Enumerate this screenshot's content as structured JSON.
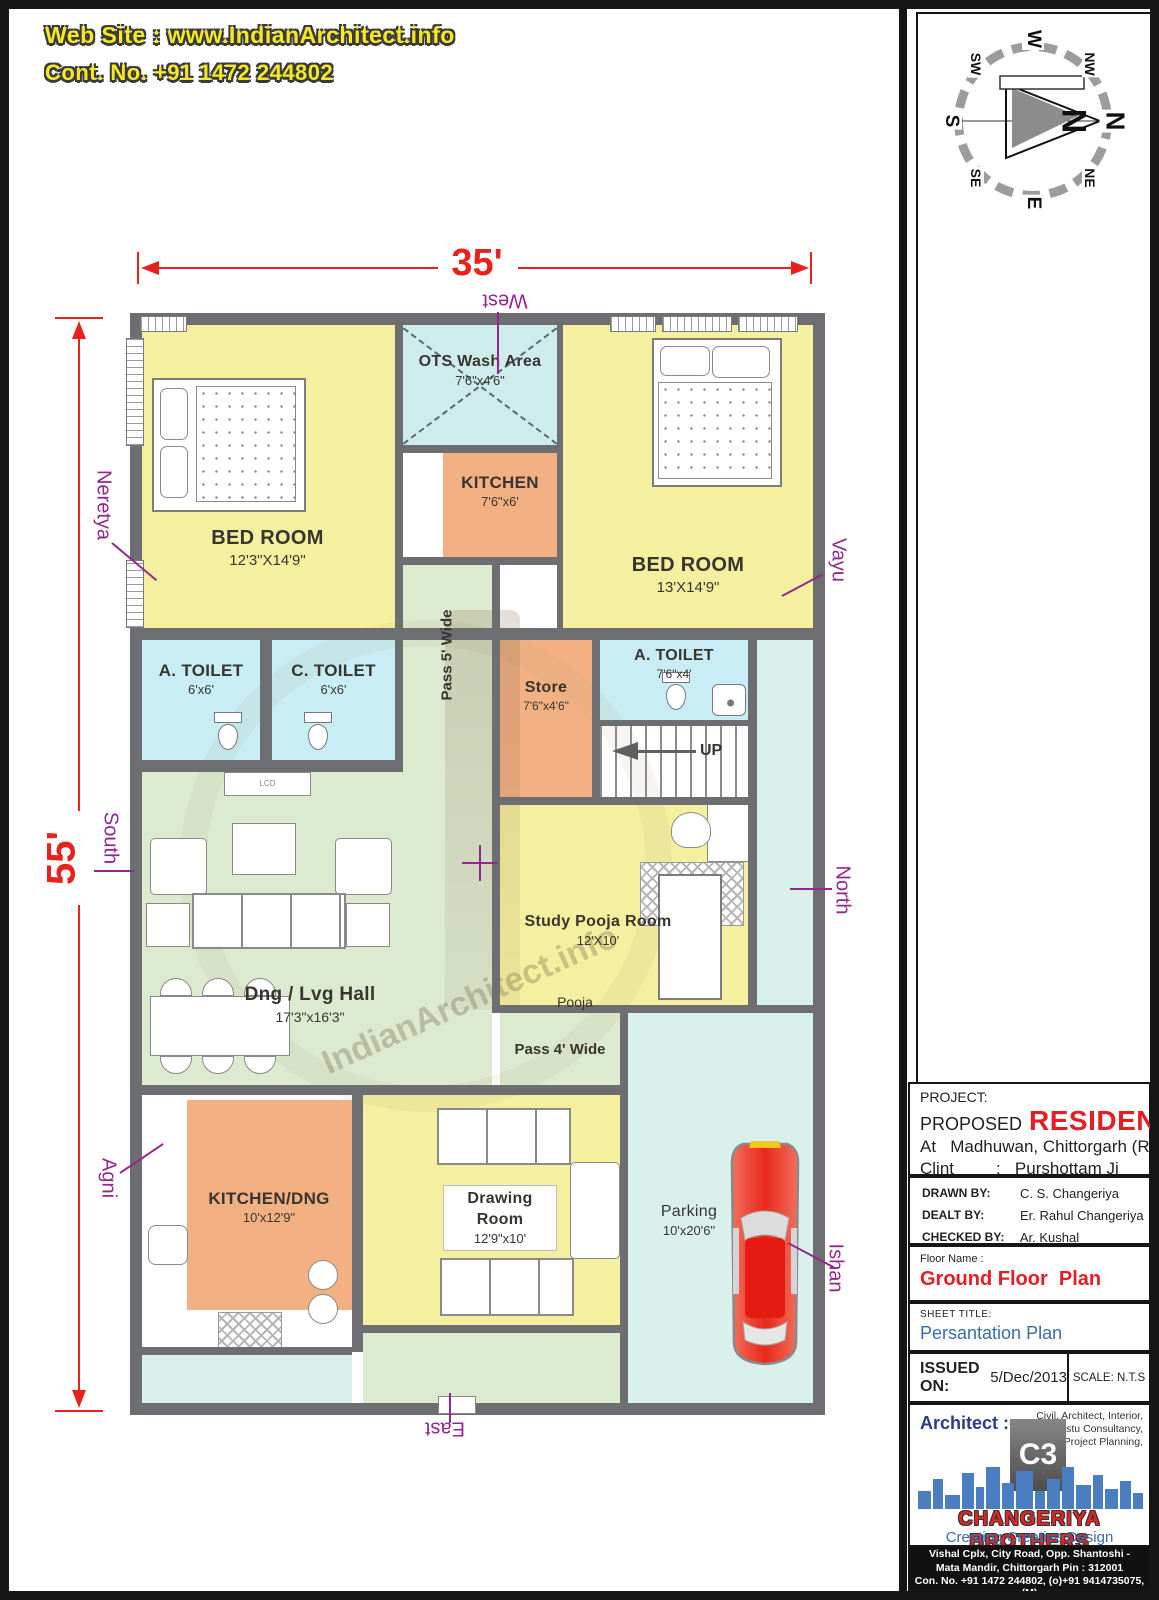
{
  "header": {
    "website": "Web Site : www.IndianArchitect.info",
    "contact": "Cont. No. +91 1472 244802"
  },
  "compass": {
    "n": "N",
    "ne": "NE",
    "e": "E",
    "se": "SE",
    "s": "S",
    "sw": "SW",
    "w": "W",
    "nw": "NW",
    "needle_n": "N"
  },
  "dimensions": {
    "width": "35'",
    "height": "55'"
  },
  "vastu": {
    "west": "West",
    "east": "East",
    "north": "North",
    "south": "South",
    "neretya": "Neretya",
    "vayu": "Vayu",
    "agni": "Agni",
    "ishan": "Ishan"
  },
  "rooms": {
    "bedroom1": {
      "name": "BED ROOM",
      "size": "12'3\"X14'9\""
    },
    "ots": {
      "name": "OTS Wash Area",
      "size": "7'6\"x4'6\""
    },
    "kitchen": {
      "name": "KITCHEN",
      "size": "7'6\"x6'"
    },
    "bedroom2": {
      "name": "BED ROOM",
      "size": "13'X14'9\""
    },
    "atoilet1": {
      "name": "A. TOILET",
      "size": "6'x6'"
    },
    "ctoilet": {
      "name": "C. TOILET",
      "size": "6'x6'"
    },
    "pass5": {
      "name": "Pass 5' Wide"
    },
    "store": {
      "name": "Store",
      "size": "7'6\"x4'6\""
    },
    "atoilet2": {
      "name": "A. TOILET",
      "size": "7'6\"x4'"
    },
    "stairs": {
      "name": "UP"
    },
    "hall": {
      "name": "Dng / Lvg Hall",
      "size": "17'3\"x16'3\""
    },
    "study": {
      "name": "Study Pooja Room",
      "size": "12'X10'"
    },
    "pooja": {
      "name": "Pooja"
    },
    "pass4": {
      "name": "Pass 4' Wide"
    },
    "kitchendng": {
      "name": "KITCHEN/DNG",
      "size": "10'x12'9\""
    },
    "drawing": {
      "name": "Drawing Room",
      "size": "12'9\"x10'"
    },
    "parking": {
      "name": "Parking",
      "size": "10'x20'6\""
    }
  },
  "furniture": {
    "lcd": "LCD"
  },
  "watermark": "IndianArchitect.info",
  "title_block": {
    "project_label": "PROJECT:",
    "proposed": "PROPOSED",
    "type": "RESIDENTIAL",
    "location": "At   Madhuwan, Chittorgarh (Raj.)",
    "client_label": "Clint",
    "client_value": ":   Purshottam Ji",
    "drawn_label": "DRAWN BY:",
    "drawn": "C. S. Changeriya",
    "dealt_label": "DEALT BY:",
    "dealt": "Er. Rahul Changeriya",
    "checked_label": "CHECKED BY:",
    "checked": "Ar. Kushal Changeriya",
    "floor_label": "Floor Name :",
    "floor_name": "Ground Floor  Plan",
    "sheet_label": "SHEET TITLE:",
    "sheet_title": "Persantation Plan",
    "issued_label": "ISSUED ON:",
    "issued_date": "5/Dec/2013",
    "scale": "SCALE: N.T.S",
    "architect_label": "Architect :-",
    "services": [
      "Civil, Architect, Interior,",
      "Vastu Consultancy,",
      "Project Planning,"
    ],
    "logo_text": "C3",
    "company": "CHANGERIYA BROTHERS",
    "tagline": "Creating Creative Design",
    "address_line1": "Vishal Cplx, City Road, Opp. Shantoshi -",
    "address_line2": "Mata Mandir, Chittorgarh Pin : 312001",
    "address_line3": "Con. No. +91 1472 244802, (o)+91 9414735075, (M)",
    "address_line4": "W: www.IndianArchitect.Info, E: info@IndianArchitect.Info"
  }
}
